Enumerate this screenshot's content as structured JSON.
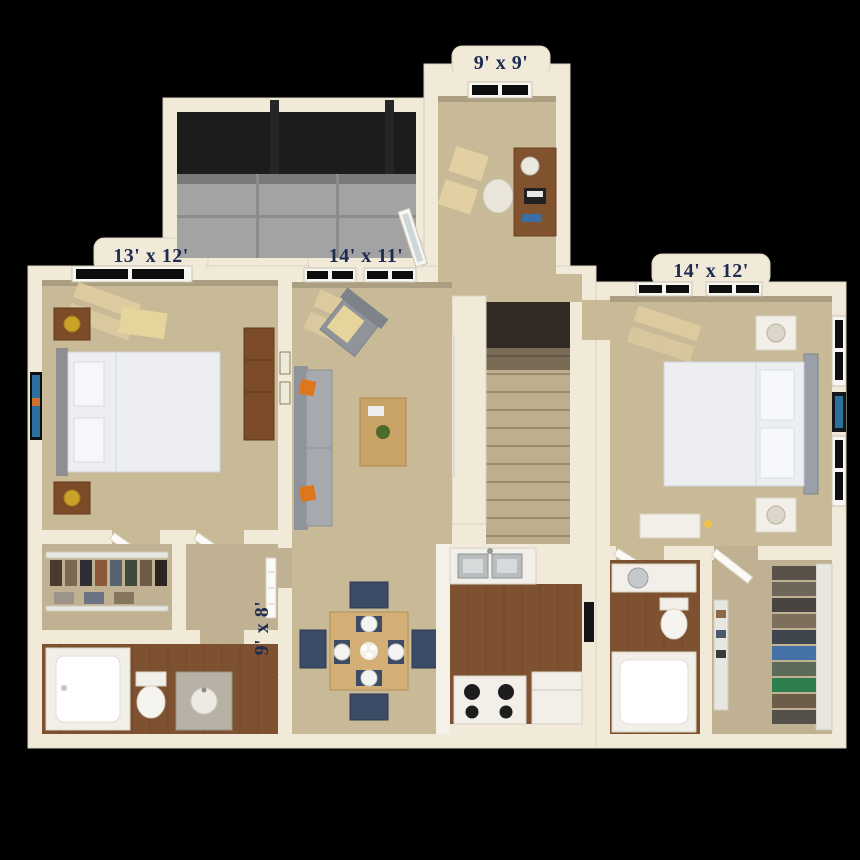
{
  "plan": {
    "type": "3d-apartment-floor-plan",
    "background": "#000000",
    "rooms": [
      {
        "id": "den",
        "dimensions": "9' x 9'",
        "furniture": [
          "desk",
          "desk-chair",
          "desk-lamp",
          "laptop",
          "window"
        ]
      },
      {
        "id": "bedroom-left",
        "dimensions": "13' x 12'",
        "furniture": [
          "bed",
          "nightstand",
          "nightstand",
          "brass-lamp",
          "wall-art",
          "bookcase",
          "window"
        ]
      },
      {
        "id": "living-room",
        "dimensions": "14' x 11'",
        "furniture": [
          "sofa",
          "orange-pillows",
          "armchair",
          "coffee-table",
          "plant",
          "tv-console",
          "tv",
          "windows",
          "wall-frames"
        ]
      },
      {
        "id": "bedroom-right",
        "dimensions": "14' x 12'",
        "furniture": [
          "bed",
          "white-nightstand",
          "white-nightstand",
          "lamp",
          "wall-art",
          "dresser",
          "candle",
          "windows"
        ]
      },
      {
        "id": "kitchen",
        "dimensions": "9' x 8'",
        "furniture": [
          "double-sink",
          "range-stove",
          "refrigerator",
          "counter"
        ]
      },
      {
        "id": "screened-patio",
        "furniture": [
          "screen-wall",
          "concrete-floor",
          "glass-door"
        ]
      },
      {
        "id": "dining-area",
        "furniture": [
          "dining-table",
          "navy-chairs",
          "place-settings",
          "centerpiece"
        ]
      },
      {
        "id": "stair-hall",
        "furniture": [
          "staircase"
        ]
      },
      {
        "id": "bathroom-left",
        "furniture": [
          "bathtub",
          "toilet",
          "granite-vanity"
        ]
      },
      {
        "id": "bathroom-right",
        "furniture": [
          "bathtub",
          "toilet",
          "vanity"
        ]
      },
      {
        "id": "walk-in-closet-left",
        "furniture": [
          "wire-shelving",
          "hanging-clothes"
        ]
      },
      {
        "id": "walk-in-closet-right",
        "furniture": [
          "wire-shelving",
          "folded-clothes",
          "shoe-rack"
        ]
      }
    ],
    "colors": {
      "wall": "#f1ead9",
      "wall_outline": "#d9d2bf",
      "carpet": "#c8b997",
      "carpet_dim": "#bfb191",
      "sunlit_carpet": "#e6d3a3",
      "wood_floor": "#7e5130",
      "patio_concrete": "#a3a3a3",
      "screen_dark": "#1c1c1c",
      "label_text": "#1d2b50",
      "sofa_gray": "#a6a9ae",
      "pillow_orange": "#e0761c",
      "chair_navy": "#3c4c66",
      "table_oak": "#d3af76",
      "bed_linen": "#eceef2",
      "nightstand_wood": "#7c4c28",
      "art_blue": "#2d6f9d",
      "brass_lamp": "#c9a227"
    }
  }
}
